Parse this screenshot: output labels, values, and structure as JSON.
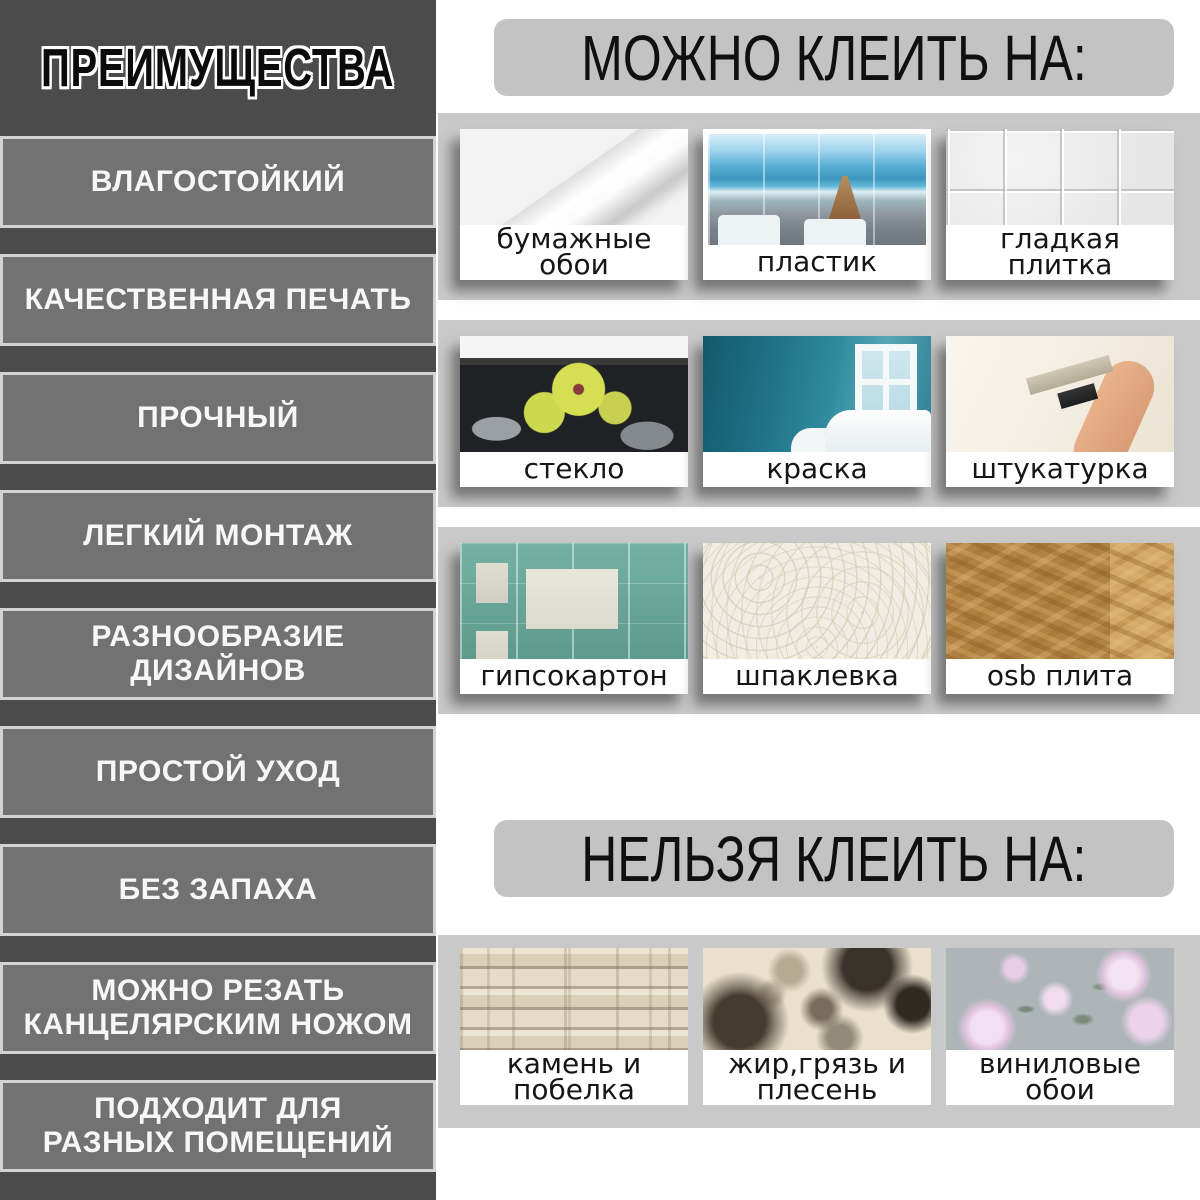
{
  "colors": {
    "page_bg": "#ffffff",
    "sidebar_bg": "#4b4b4b",
    "item_bg": "#727272",
    "item_border": "#d2d2d2",
    "item_text": "#f7f7f7",
    "title_fill": "#0b0b0b",
    "title_outline": "#ffffff",
    "band_bg": "#c9c9c9",
    "header_pill_bg": "#c3c3c3",
    "header_text": "#101010",
    "tile_label_text": "#161616"
  },
  "sidebar": {
    "title": "ПРЕИМУЩЕСТВА",
    "items": [
      {
        "label": "ВЛАГОСТОЙКИЙ"
      },
      {
        "label": "КАЧЕСТВЕННАЯ ПЕЧАТЬ"
      },
      {
        "label": "ПРОЧНЫЙ"
      },
      {
        "label": "ЛЕГКИЙ МОНТАЖ"
      },
      {
        "label": "РАЗНООБРАЗИЕ ДИЗАЙНОВ"
      },
      {
        "label": "ПРОСТОЙ УХОД"
      },
      {
        "label": "БЕЗ ЗАПАХА"
      },
      {
        "label": "МОЖНО РЕЗАТЬ\nКАНЦЕЛЯРСКИМ НОЖОМ"
      },
      {
        "label": "ПОДХОДИТ ДЛЯ\nРАЗНЫХ ПОМЕЩЕНИЙ"
      }
    ]
  },
  "can_section": {
    "title": "МОЖНО КЛЕИТЬ НА:",
    "rows": [
      {
        "tiles": [
          {
            "label": "бумажные обои",
            "image": "paper-wallpaper-roll-photo"
          },
          {
            "label": "пластик",
            "image": "plastic-panels-bathroom-photo"
          },
          {
            "label": "гладкая плитка",
            "image": "smooth-tile-photo"
          }
        ]
      },
      {
        "tiles": [
          {
            "label": "стекло",
            "image": "glass-backsplash-photo"
          },
          {
            "label": "краска",
            "image": "painted-wall-photo"
          },
          {
            "label": "штукатурка",
            "image": "plaster-trowel-photo"
          }
        ]
      },
      {
        "tiles": [
          {
            "label": "гипсокартон",
            "image": "drywall-photo"
          },
          {
            "label": "шпаклевка",
            "image": "putty-texture-photo"
          },
          {
            "label": "osb плита",
            "image": "osb-board-photo"
          }
        ]
      }
    ]
  },
  "cannot_section": {
    "title": "НЕЛЬЗЯ КЛЕИТЬ НА:",
    "rows": [
      {
        "tiles": [
          {
            "label": "камень и побелка",
            "image": "stone-whitewash-photo"
          },
          {
            "label": "жир,грязь и\nплесень",
            "image": "grease-dirt-mold-photo"
          },
          {
            "label": "виниловые обои",
            "image": "vinyl-wallpaper-photo"
          }
        ]
      }
    ]
  }
}
